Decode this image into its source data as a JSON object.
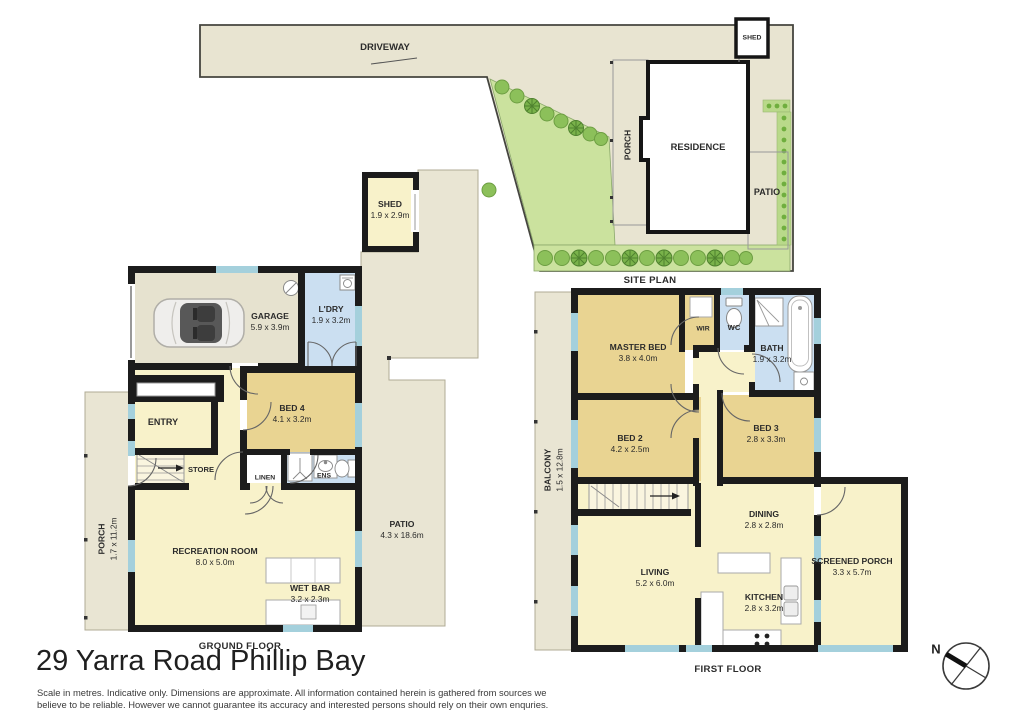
{
  "title": "29 Yarra Road Phillip Bay",
  "disclaimer": {
    "line1": "Scale in metres. Indicative only. Dimensions are approximate. All information contained herein is gathered from sources we",
    "line2": "believe to be reliable. However we cannot guarantee its accuracy and interested persons should rely on their own enquries."
  },
  "compass": {
    "north_label": "N"
  },
  "site_plan": {
    "caption": "SITE PLAN",
    "driveway_label": "DRIVEWAY",
    "shed_label": "SHED",
    "porch_label": "PORCH",
    "residence_label": "RESIDENCE",
    "patio_label": "PATIO"
  },
  "ground_floor": {
    "caption": "GROUND FLOOR",
    "rooms": {
      "shed": {
        "name": "SHED",
        "dims": "1.9 x 2.9m"
      },
      "garage": {
        "name": "GARAGE",
        "dims": "5.9 x 3.9m"
      },
      "laundry": {
        "name": "L'DRY",
        "dims": "1.9 x 3.2m"
      },
      "bed4": {
        "name": "BED 4",
        "dims": "4.1 x 3.2m"
      },
      "entry": {
        "name": "ENTRY"
      },
      "store": {
        "name": "STORE"
      },
      "linen": {
        "name": "LINEN"
      },
      "ensuite": {
        "name": "ENS"
      },
      "recreation_room": {
        "name": "RECREATION ROOM",
        "dims": "8.0 x 5.0m"
      },
      "wet_bar": {
        "name": "WET BAR",
        "dims": "3.2 x 2.3m"
      },
      "porch": {
        "name": "PORCH",
        "dims": "1.7 x 11.2m"
      },
      "patio": {
        "name": "PATIO",
        "dims": "4.3 x 18.6m"
      }
    }
  },
  "first_floor": {
    "caption": "FIRST FLOOR",
    "rooms": {
      "master_bed": {
        "name": "MASTER BED",
        "dims": "3.8 x 4.0m"
      },
      "wir": {
        "name": "WIR"
      },
      "wc": {
        "name": "WC"
      },
      "bath": {
        "name": "BATH",
        "dims": "1.9 x 3.2m"
      },
      "bed2": {
        "name": "BED 2",
        "dims": "4.2 x 2.5m"
      },
      "bed3": {
        "name": "BED 3",
        "dims": "2.8 x 3.3m"
      },
      "balcony": {
        "name": "BALCONY",
        "dims": "1.5 x 12.8m"
      },
      "dining": {
        "name": "DINING",
        "dims": "2.8 x 2.8m"
      },
      "living": {
        "name": "LIVING",
        "dims": "5.2 x 6.0m"
      },
      "kitchen": {
        "name": "KITCHEN",
        "dims": "2.8 x 3.2m"
      },
      "screened_porch": {
        "name": "SCREENED PORCH",
        "dims": "3.3 x 5.7m"
      }
    }
  },
  "colors": {
    "room_yellow": "#f8f2ca",
    "bedroom_tan": "#e9d492",
    "wet_area_blue": "#cbdff1",
    "outdoor_beige": "#e9e5d3",
    "garden_green": "#cbe29e",
    "tree_green": "#8cc05a",
    "window_cyan": "#a4d0dc",
    "wall_black": "#1c1c1c"
  }
}
